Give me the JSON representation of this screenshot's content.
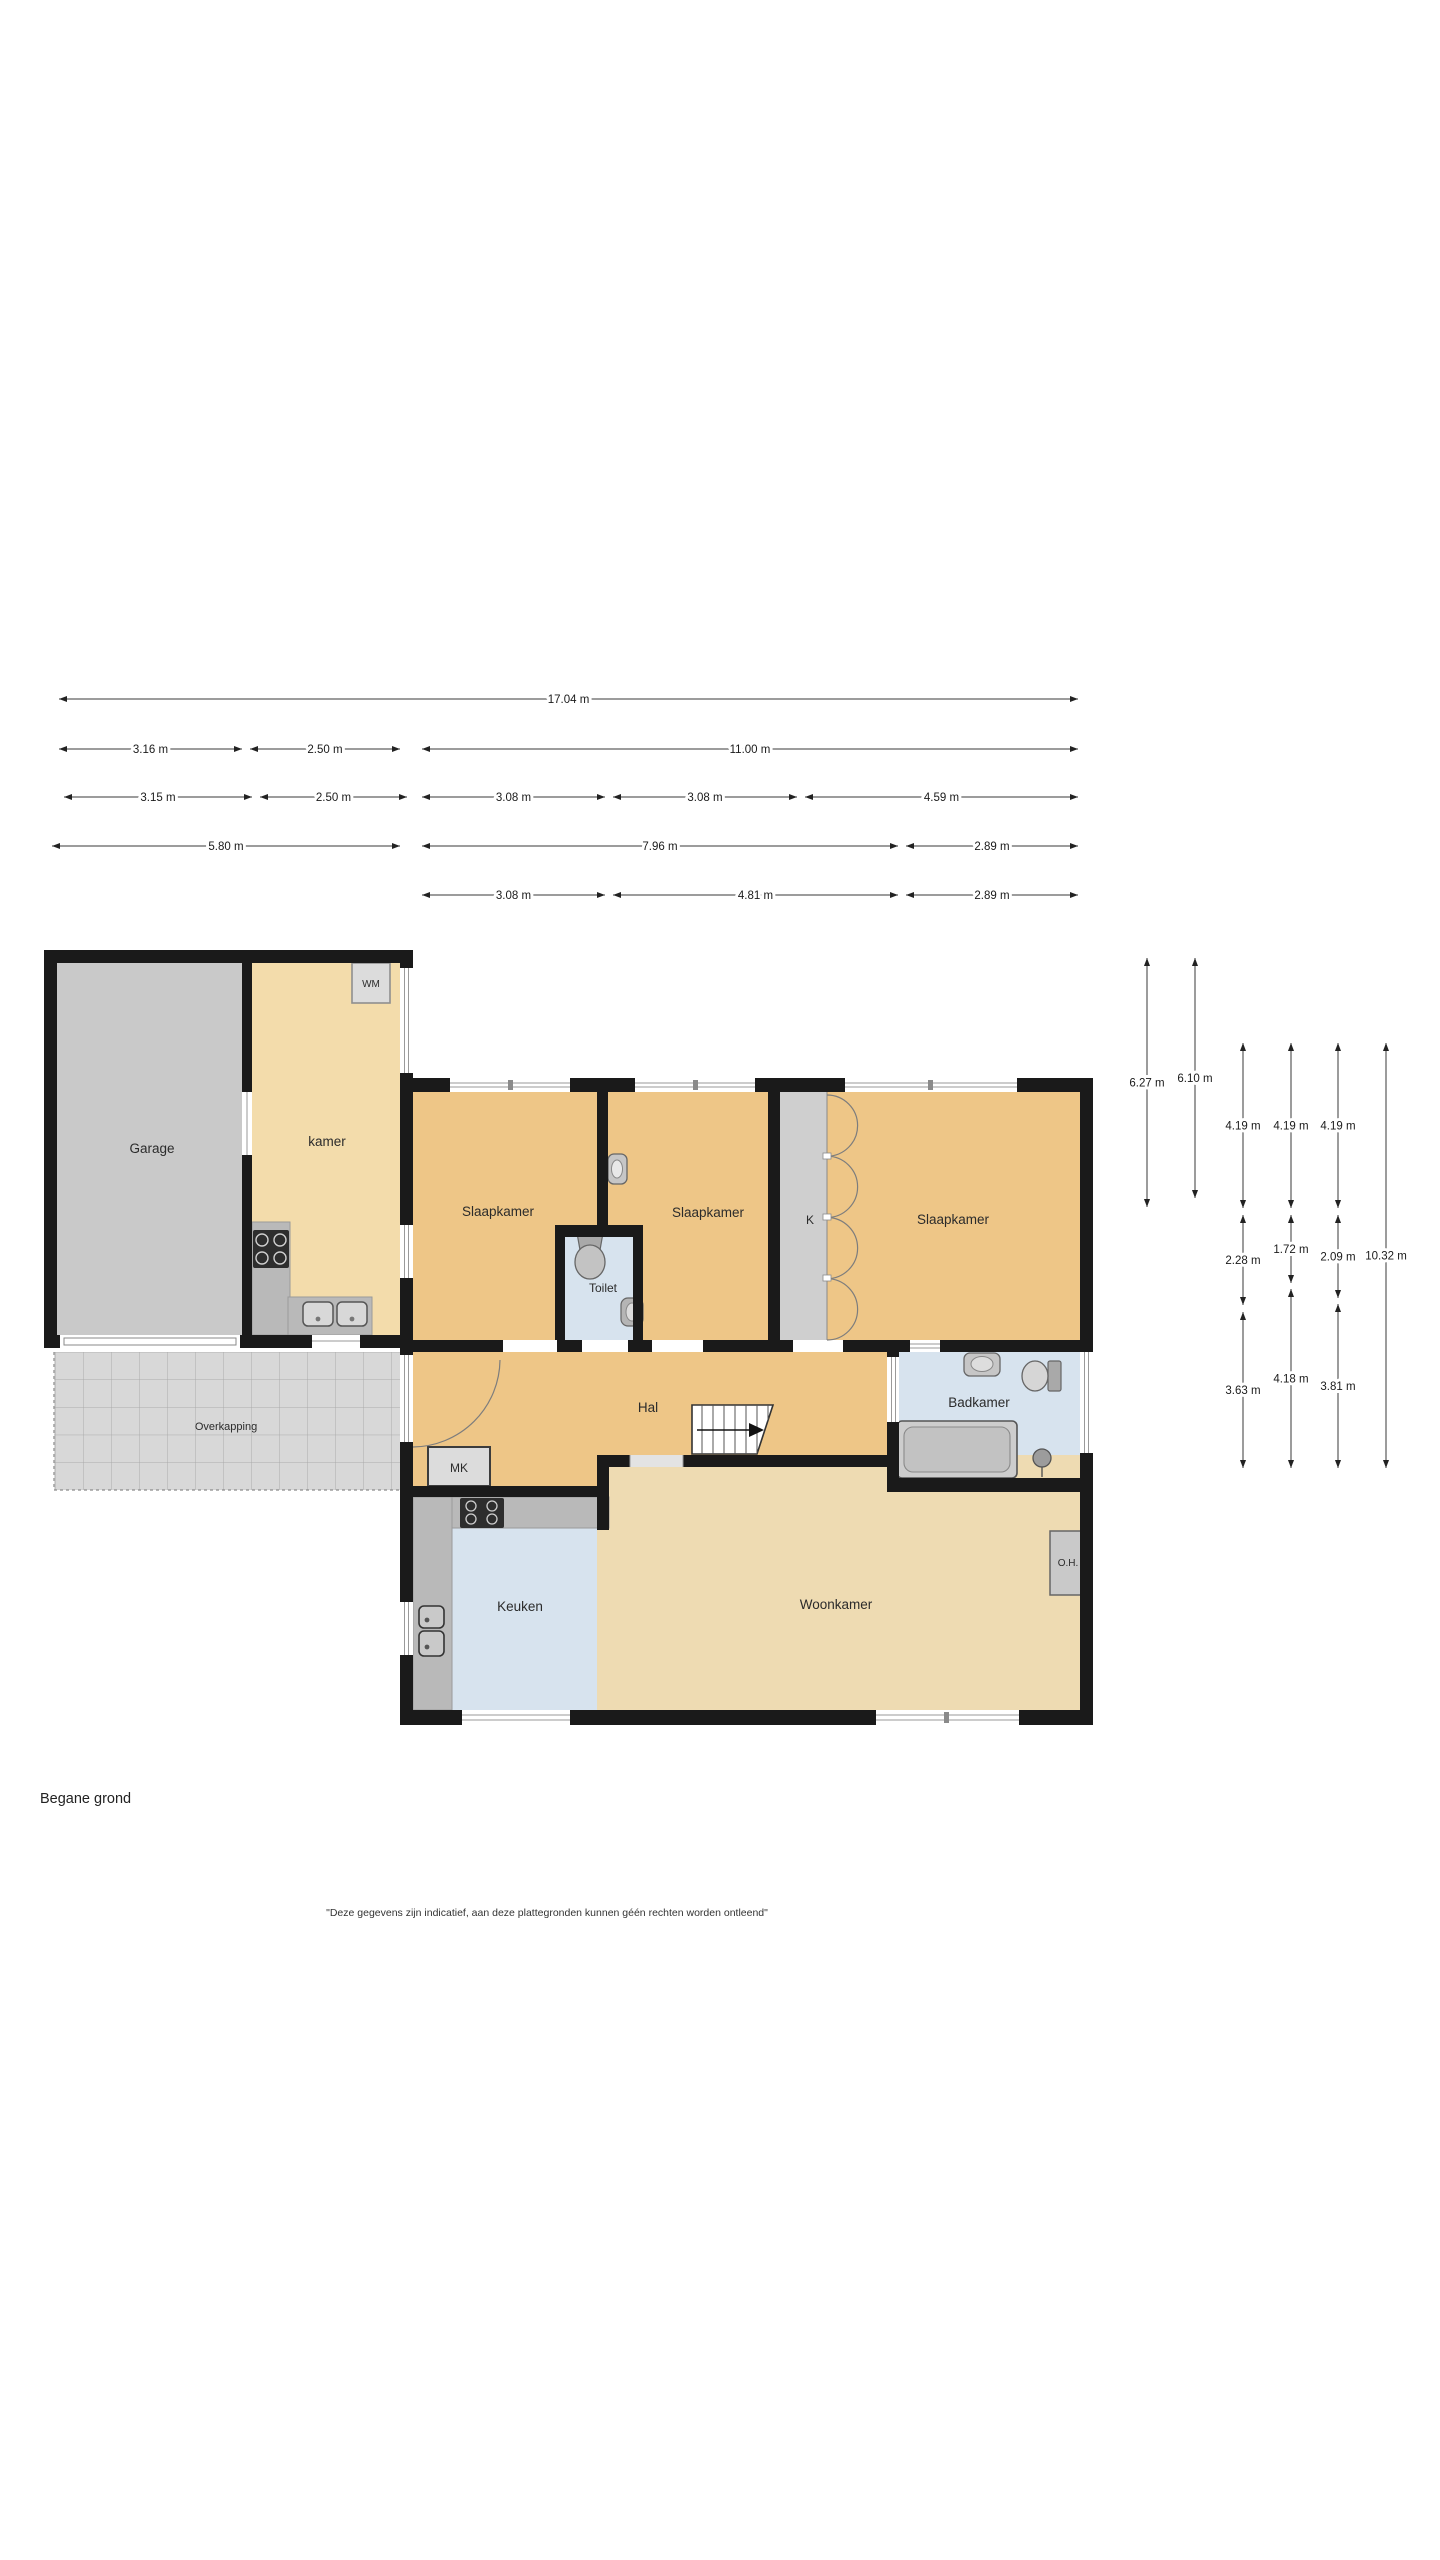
{
  "plan": {
    "floor_label": "Begane grond",
    "disclaimer": "\"Deze gegevens zijn indicatief, aan deze plattegronden kunnen géén rechten worden ontleend\"",
    "rooms": {
      "garage": "Garage",
      "kamer": "kamer",
      "wm": "WM",
      "slaapkamer_links": "Slaapkamer",
      "slaapkamer_midden": "Slaapkamer",
      "slaapkamer_rechts": "Slaapkamer",
      "toilet": "Toilet",
      "kast": "K",
      "hal": "Hal",
      "meterkast": "MK",
      "badkamer": "Badkamer",
      "keuken": "Keuken",
      "woonkamer": "Woonkamer",
      "onderhoud_kast": "O.H.",
      "overkapping": "Overkapping"
    },
    "colors": {
      "wall": "#1a1a1a",
      "floor_amber": "#eec687",
      "floor_pale_tan": "#f3dcab",
      "floor_living": "#eedbb2",
      "floor_wet_blue": "#d7e3ee",
      "floor_garage_gray": "#c9c9c9",
      "counter_gray": "#b9b9b9",
      "overkapping_gray": "#d8d8d8"
    },
    "dimensions_horizontal": [
      {
        "y": 699,
        "segments": [
          {
            "x1": 59,
            "x2": 1078,
            "label": "17.04 m"
          }
        ]
      },
      {
        "y": 749,
        "segments": [
          {
            "x1": 59,
            "x2": 242,
            "label": "3.16 m"
          },
          {
            "x1": 250,
            "x2": 400,
            "label": "2.50 m"
          },
          {
            "x1": 422,
            "x2": 1078,
            "label": "11.00 m"
          }
        ]
      },
      {
        "y": 797,
        "segments": [
          {
            "x1": 64,
            "x2": 252,
            "label": "3.15 m"
          },
          {
            "x1": 260,
            "x2": 407,
            "label": "2.50 m"
          },
          {
            "x1": 422,
            "x2": 605,
            "label": "3.08 m"
          },
          {
            "x1": 613,
            "x2": 797,
            "label": "3.08 m"
          },
          {
            "x1": 805,
            "x2": 1078,
            "label": "4.59 m"
          }
        ]
      },
      {
        "y": 846,
        "segments": [
          {
            "x1": 52,
            "x2": 400,
            "label": "5.80 m"
          },
          {
            "x1": 422,
            "x2": 898,
            "label": "7.96 m"
          },
          {
            "x1": 906,
            "x2": 1078,
            "label": "2.89 m"
          }
        ]
      },
      {
        "y": 895,
        "segments": [
          {
            "x1": 422,
            "x2": 605,
            "label": "3.08 m"
          },
          {
            "x1": 613,
            "x2": 898,
            "label": "4.81 m"
          },
          {
            "x1": 906,
            "x2": 1078,
            "label": "2.89 m"
          }
        ]
      }
    ],
    "dimensions_vertical": [
      {
        "x": 1147,
        "segments": [
          {
            "y1": 958,
            "y2": 1207,
            "label": "6.27 m"
          }
        ]
      },
      {
        "x": 1195,
        "segments": [
          {
            "y1": 958,
            "y2": 1198,
            "label": "6.10 m"
          }
        ]
      },
      {
        "x": 1243,
        "segments": [
          {
            "y1": 1043,
            "y2": 1208,
            "label": "4.19 m"
          },
          {
            "y1": 1215,
            "y2": 1305,
            "label": "2.28 m"
          },
          {
            "y1": 1312,
            "y2": 1468,
            "label": "3.63 m"
          }
        ]
      },
      {
        "x": 1291,
        "segments": [
          {
            "y1": 1043,
            "y2": 1208,
            "label": "4.19 m"
          },
          {
            "y1": 1215,
            "y2": 1283,
            "label": "1.72 m"
          },
          {
            "y1": 1289,
            "y2": 1468,
            "label": "4.18 m"
          }
        ]
      },
      {
        "x": 1338,
        "segments": [
          {
            "y1": 1043,
            "y2": 1208,
            "label": "4.19 m"
          },
          {
            "y1": 1215,
            "y2": 1298,
            "label": "2.09 m"
          },
          {
            "y1": 1304,
            "y2": 1468,
            "label": "3.81 m"
          }
        ]
      },
      {
        "x": 1386,
        "segments": [
          {
            "y1": 1043,
            "y2": 1468,
            "label": "10.32 m"
          }
        ]
      }
    ]
  }
}
